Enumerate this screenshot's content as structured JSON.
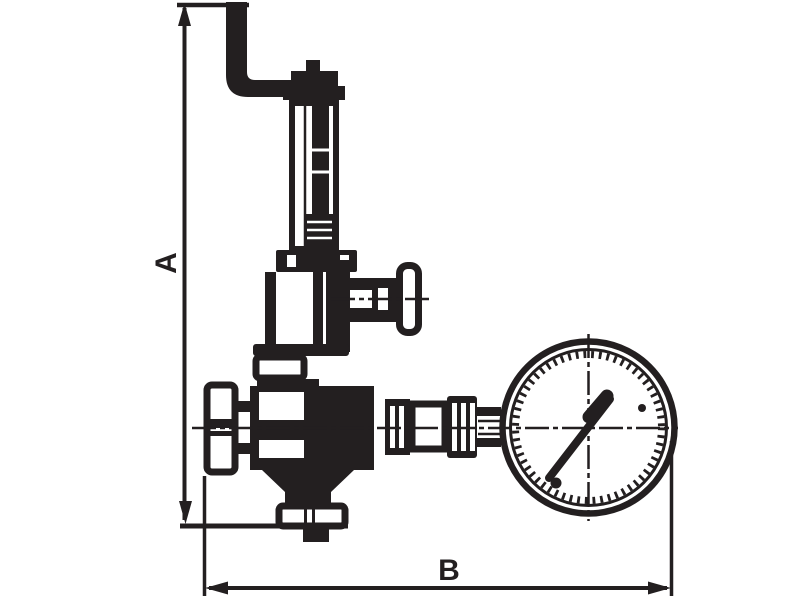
{
  "diagram": {
    "type": "technical-line-drawing",
    "subject": "Safety relief valve assembly with vent pipe elbow, spring housing, adjustment tee handle, knurled inlet nut, bottom outlet flange and pressure gauge",
    "ink_color": "#231f20",
    "background_color": "#ffffff",
    "dimension_labels": {
      "vertical": "A",
      "horizontal": "B"
    },
    "components": [
      "dimension-line-a",
      "dimension-line-b",
      "vent-pipe-elbow",
      "cap-and-nipple",
      "spring-housing",
      "housing-flange",
      "bonnet-yoke",
      "adjustment-tee-handle",
      "valve-body",
      "inlet-union-nut",
      "bottom-outlet-flange",
      "gauge-coupling-train",
      "pressure-gauge",
      "gauge-needle"
    ]
  }
}
